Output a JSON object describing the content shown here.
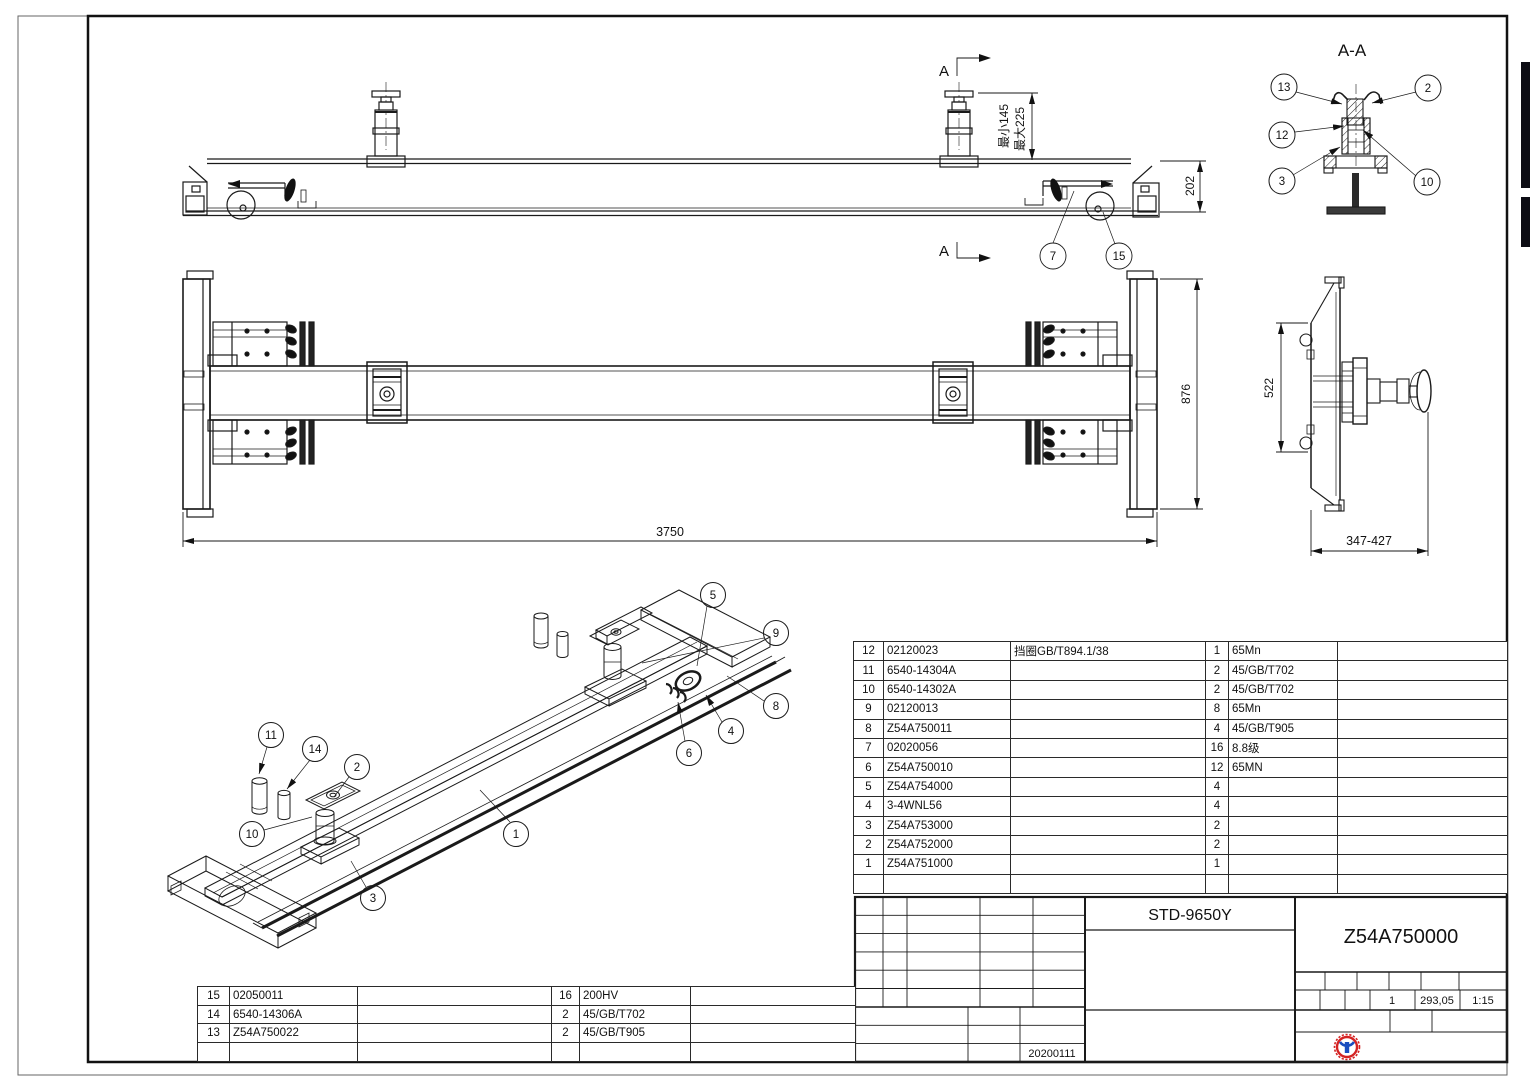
{
  "drawing": {
    "section_title": "A-A",
    "section_marker": "A",
    "dims": {
      "beam_height": "202",
      "plate_height": "876",
      "total_length": "3750",
      "side_height": "522",
      "side_width": "347-427",
      "jack_min": "最小145",
      "jack_max": "最大225"
    },
    "callouts": {
      "top_view": [
        "7",
        "15"
      ],
      "section": [
        "13",
        "12",
        "3",
        "2",
        "10"
      ],
      "iso": [
        "5",
        "9",
        "8",
        "4",
        "6",
        "11",
        "14",
        "2",
        "10",
        "1",
        "3"
      ]
    }
  },
  "bom_right": {
    "rows": [
      {
        "no": "12",
        "part": "02120023",
        "desc": "挡圈GB/T894.1/38",
        "qty": "1",
        "material": "65Mn",
        "remark": ""
      },
      {
        "no": "11",
        "part": "6540-14304A",
        "desc": "",
        "qty": "2",
        "material": "45/GB/T702",
        "remark": ""
      },
      {
        "no": "10",
        "part": "6540-14302A",
        "desc": "",
        "qty": "2",
        "material": "45/GB/T702",
        "remark": ""
      },
      {
        "no": "9",
        "part": "02120013",
        "desc": "",
        "qty": "8",
        "material": "65Mn",
        "remark": ""
      },
      {
        "no": "8",
        "part": "Z54A750011",
        "desc": "",
        "qty": "4",
        "material": "45/GB/T905",
        "remark": ""
      },
      {
        "no": "7",
        "part": "02020056",
        "desc": "",
        "qty": "16",
        "material": "8.8级",
        "remark": ""
      },
      {
        "no": "6",
        "part": "Z54A750010",
        "desc": "",
        "qty": "12",
        "material": "65MN",
        "remark": ""
      },
      {
        "no": "5",
        "part": "Z54A754000",
        "desc": "",
        "qty": "4",
        "material": "",
        "remark": ""
      },
      {
        "no": "4",
        "part": "3-4WNL56",
        "desc": "",
        "qty": "4",
        "material": "",
        "remark": ""
      },
      {
        "no": "3",
        "part": "Z54A753000",
        "desc": "",
        "qty": "2",
        "material": "",
        "remark": ""
      },
      {
        "no": "2",
        "part": "Z54A752000",
        "desc": "",
        "qty": "2",
        "material": "",
        "remark": ""
      },
      {
        "no": "1",
        "part": "Z54A751000",
        "desc": "",
        "qty": "1",
        "material": "",
        "remark": ""
      }
    ]
  },
  "bom_left": {
    "rows": [
      {
        "no": "15",
        "part": "02050011",
        "desc": "",
        "qty": "16",
        "material": "200HV",
        "remark": ""
      },
      {
        "no": "14",
        "part": "6540-14306A",
        "desc": "",
        "qty": "2",
        "material": "45/GB/T702",
        "remark": ""
      },
      {
        "no": "13",
        "part": "Z54A750022",
        "desc": "",
        "qty": "2",
        "material": "45/GB/T905",
        "remark": ""
      }
    ]
  },
  "title_block": {
    "model": "STD-9650Y",
    "drawing_no": "Z54A750000",
    "sheet": "1",
    "weight": "293,05",
    "scale": "1:15",
    "date": "20200111"
  }
}
